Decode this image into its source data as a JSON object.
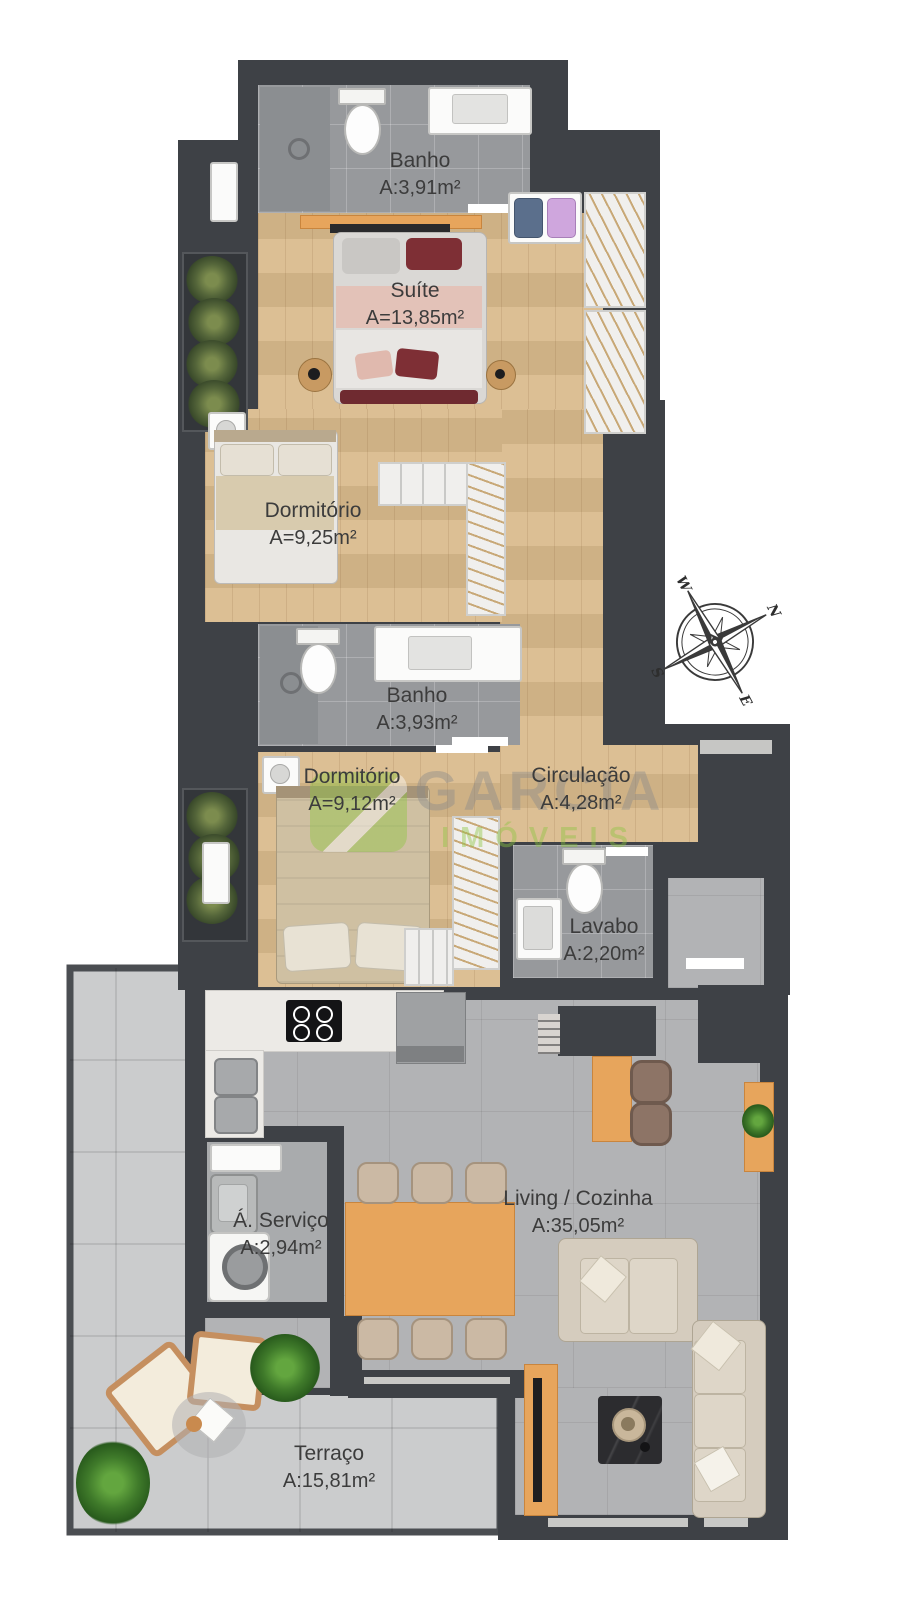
{
  "rooms": {
    "banho1": {
      "name": "Banho",
      "area": "A:3,91m²"
    },
    "suite": {
      "name": "Suíte",
      "area": "A=13,85m²"
    },
    "dormitorio1": {
      "name": "Dormitório",
      "area": "A=9,25m²"
    },
    "banho2": {
      "name": "Banho",
      "area": "A:3,93m²"
    },
    "dormitorio2": {
      "name": "Dormitório",
      "area": "A=9,12m²"
    },
    "circulacao": {
      "name": "Circulação",
      "area": "A:4,28m²"
    },
    "lavabo": {
      "name": "Lavabo",
      "area": "A:2,20m²"
    },
    "servico": {
      "name": "Á. Serviço",
      "area": "A:2,94m²"
    },
    "living": {
      "name": "Living / Cozinha",
      "area": "A:35,05m²"
    },
    "terraco": {
      "name": "Terraço",
      "area": "A:15,81m²"
    }
  },
  "compass": {
    "n": "N",
    "s": "S",
    "e": "E",
    "w": "W"
  },
  "watermark": {
    "brand": "GARCIA",
    "subtitle": "IMÓVEIS"
  },
  "colors": {
    "wall": "#3e4146",
    "wood_floor": "#d9ba8c",
    "bath_tile": "#97999c",
    "living_tile": "#b2b3b5",
    "terrace_tile": "#cbcccd",
    "accent_wood": "#e7a55c",
    "watermark_green": "#8cc63f"
  }
}
